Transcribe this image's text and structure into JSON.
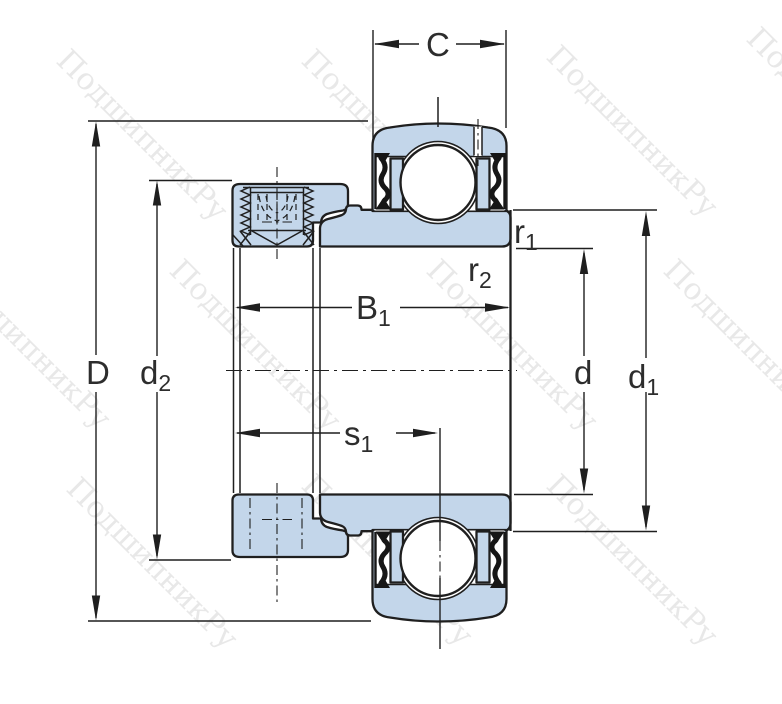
{
  "drawing": {
    "type": "bearing-cross-section-diagram",
    "watermark_text": "ПодшипникРу",
    "colors": {
      "line": "#1f1f1f",
      "blue": "#c3d6ea",
      "seal": "#161616",
      "label": "#2d2d2d",
      "watermark": "#e8e8e8",
      "background": "#ffffff"
    },
    "dimension_labels": {
      "C": {
        "base": "C"
      },
      "D": {
        "base": "D"
      },
      "d2": {
        "base": "d",
        "sub": "2"
      },
      "B1": {
        "base": "B",
        "sub": "1"
      },
      "s1": {
        "base": "s",
        "sub": "1"
      },
      "r1": {
        "base": "r",
        "sub": "1"
      },
      "r2": {
        "base": "r",
        "sub": "2"
      },
      "d": {
        "base": "d"
      },
      "d1": {
        "base": "d",
        "sub": "1"
      }
    }
  }
}
